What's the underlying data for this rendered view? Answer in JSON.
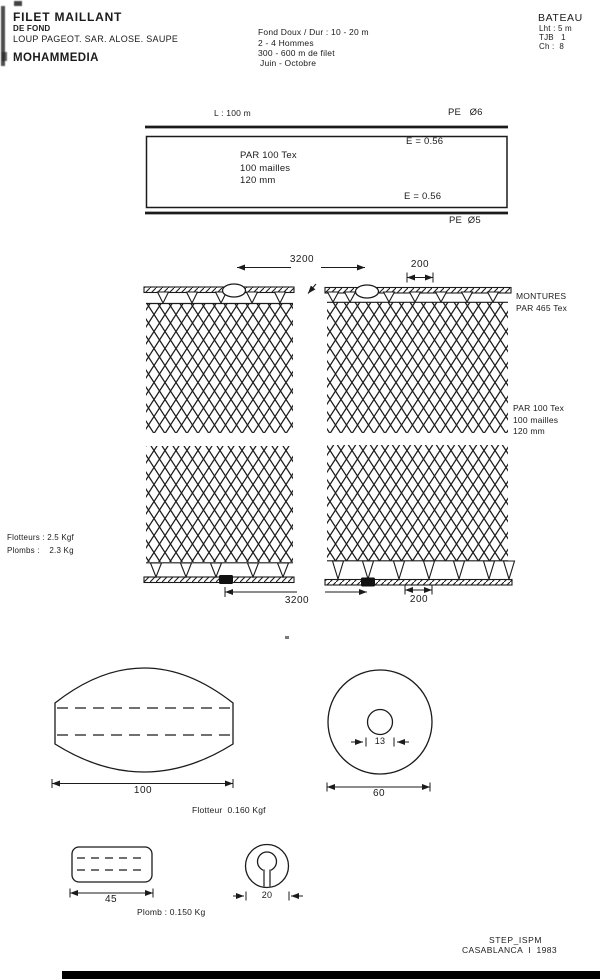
{
  "header": {
    "title": "FILET MAILLANT",
    "subtitle": "DE FOND",
    "species": "LOUP PAGEOT. SAR. ALOSE. SAUPE",
    "port": "MOHAMMEDIA",
    "operation": {
      "depth": "Fond Doux / Dur : 10 - 20 m",
      "crew": "2 - 4 Hommes",
      "net_length": "300 - 600 m de filet",
      "season": "Juin - Octobre"
    },
    "boat": {
      "title": "BATEAU",
      "length": "Lht : 5 m",
      "tonnage": "TJB   1",
      "power": "Ch :  8"
    }
  },
  "plan_view": {
    "length": "L : 100 m",
    "headrope": "PE   Ø6",
    "footrope": "PE  Ø5",
    "hanging_top": "E = 0.56",
    "hanging_bottom": "E = 0.56",
    "netting": {
      "twine": "PAR 100 Tex",
      "meshes": "100 mailles",
      "mesh_size": "120 mm"
    }
  },
  "net_detail": {
    "float_spacing": "3200",
    "norsel_spacing_top": "200",
    "mounting_line1": "MONTURES",
    "mounting_line2": "PAR 465 Tex",
    "netting": {
      "twine": "PAR 100 Tex",
      "meshes": "100 mailles",
      "mesh_size": "120 mm"
    },
    "buoyancy": "Flotteurs : 2.5 Kgf",
    "ballast": "Plombs :    2.3 Kg",
    "lead_spacing": "3200",
    "norsel_spacing_bottom": "200"
  },
  "float_detail": {
    "length": "100",
    "label": "Flotteur  0.160 Kgf",
    "hole_diameter": "13",
    "diameter": "60"
  },
  "lead_detail": {
    "length": "45",
    "label": "Plomb : 0.150 Kg",
    "diameter": "20"
  },
  "footer": {
    "line1": "STEP_ISPM",
    "line2": "CASABLANCA  I  1983"
  },
  "colors": {
    "ink": "#1b1b1b",
    "paper": "#ffffff"
  }
}
